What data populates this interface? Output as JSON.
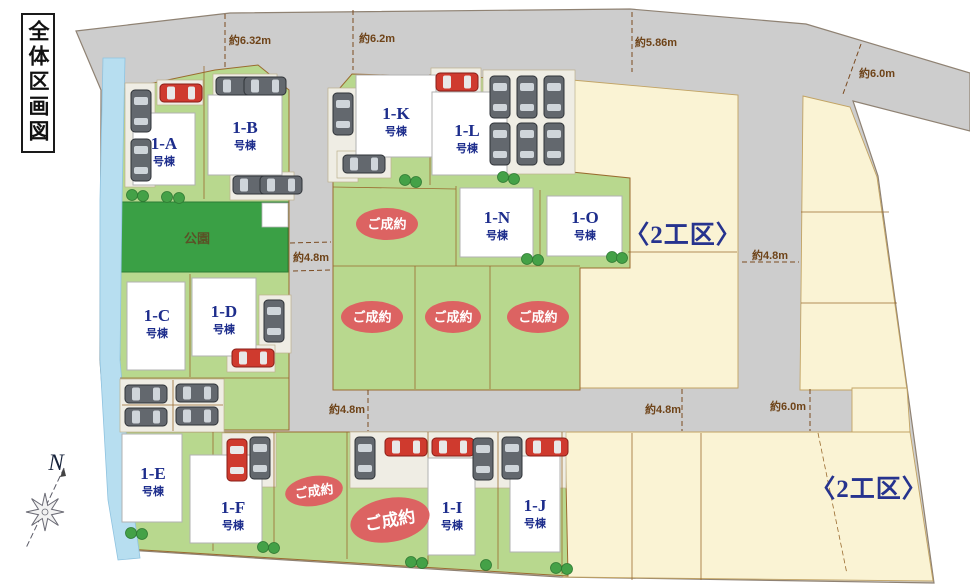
{
  "title": "全体区画図",
  "park": {
    "label": "公園"
  },
  "compass": {
    "label": "N"
  },
  "unit_suffix": "号棟",
  "sold_label": "ご成約",
  "zones": [
    {
      "label": "〈2工区〉",
      "x": 683,
      "y": 243
    },
    {
      "label": "〈2工区〉",
      "x": 869,
      "y": 497
    }
  ],
  "houses": [
    {
      "id": "1-A",
      "x": 133,
      "y": 113,
      "w": 62,
      "h": 72,
      "lx": 164,
      "ly": 149
    },
    {
      "id": "1-B",
      "x": 208,
      "y": 95,
      "w": 74,
      "h": 80,
      "lx": 245,
      "ly": 133
    },
    {
      "id": "1-C",
      "x": 127,
      "y": 282,
      "w": 58,
      "h": 88,
      "lx": 157,
      "ly": 321
    },
    {
      "id": "1-D",
      "x": 192,
      "y": 278,
      "w": 64,
      "h": 78,
      "lx": 224,
      "ly": 317
    },
    {
      "id": "1-E",
      "x": 122,
      "y": 434,
      "w": 60,
      "h": 88,
      "lx": 153,
      "ly": 479
    },
    {
      "id": "1-F",
      "x": 190,
      "y": 455,
      "w": 72,
      "h": 88,
      "lx": 233,
      "ly": 513
    },
    {
      "id": "1-I",
      "x": 428,
      "y": 458,
      "w": 47,
      "h": 97,
      "lx": 452,
      "ly": 513
    },
    {
      "id": "1-J",
      "x": 510,
      "y": 456,
      "w": 50,
      "h": 96,
      "lx": 535,
      "ly": 511
    },
    {
      "id": "1-K",
      "x": 356,
      "y": 75,
      "w": 80,
      "h": 82,
      "lx": 396,
      "ly": 119
    },
    {
      "id": "1-L",
      "x": 432,
      "y": 92,
      "w": 75,
      "h": 83,
      "lx": 467,
      "ly": 136
    },
    {
      "id": "1-N",
      "x": 460,
      "y": 188,
      "w": 73,
      "h": 69,
      "lx": 497,
      "ly": 223
    },
    {
      "id": "1-O",
      "x": 547,
      "y": 196,
      "w": 75,
      "h": 60,
      "lx": 585,
      "ly": 223
    }
  ],
  "sold": [
    {
      "cx": 387,
      "cy": 224,
      "rx": 31,
      "ry": 16,
      "rot": 0,
      "fs": 13
    },
    {
      "cx": 372,
      "cy": 317,
      "rx": 31,
      "ry": 16,
      "rot": 0,
      "fs": 13
    },
    {
      "cx": 453,
      "cy": 317,
      "rx": 28,
      "ry": 16,
      "rot": 0,
      "fs": 13
    },
    {
      "cx": 538,
      "cy": 317,
      "rx": 31,
      "ry": 16,
      "rot": 0,
      "fs": 13
    },
    {
      "cx": 314,
      "cy": 491,
      "rx": 29,
      "ry": 15,
      "rot": -8,
      "fs": 13
    },
    {
      "cx": 390,
      "cy": 520,
      "rx": 40,
      "ry": 22,
      "rot": -10,
      "fs": 17
    }
  ],
  "measurements": [
    {
      "text": "約6.32m",
      "x": 250,
      "y": 44
    },
    {
      "text": "約6.2m",
      "x": 377,
      "y": 42
    },
    {
      "text": "約5.86m",
      "x": 656,
      "y": 46
    },
    {
      "text": "約6.0m",
      "x": 877,
      "y": 77
    },
    {
      "text": "約4.8m",
      "x": 311,
      "y": 261
    },
    {
      "text": "約4.8m",
      "x": 770,
      "y": 259
    },
    {
      "text": "約4.8m",
      "x": 347,
      "y": 413
    },
    {
      "text": "約4.8m",
      "x": 663,
      "y": 413
    },
    {
      "text": "約6.0m",
      "x": 788,
      "y": 410
    }
  ],
  "cars": [
    {
      "x": 131,
      "y": 90,
      "o": "v",
      "c": "g"
    },
    {
      "x": 131,
      "y": 139,
      "o": "v",
      "c": "g"
    },
    {
      "x": 160,
      "y": 84,
      "o": "h",
      "c": "r"
    },
    {
      "x": 216,
      "y": 77,
      "o": "h",
      "c": "g"
    },
    {
      "x": 244,
      "y": 77,
      "o": "h",
      "c": "g"
    },
    {
      "x": 233,
      "y": 176,
      "o": "h",
      "c": "g"
    },
    {
      "x": 260,
      "y": 176,
      "o": "h",
      "c": "g"
    },
    {
      "x": 264,
      "y": 300,
      "o": "v",
      "c": "g"
    },
    {
      "x": 232,
      "y": 349,
      "o": "h",
      "c": "r"
    },
    {
      "x": 125,
      "y": 385,
      "o": "h",
      "c": "g"
    },
    {
      "x": 176,
      "y": 384,
      "o": "h",
      "c": "g"
    },
    {
      "x": 125,
      "y": 408,
      "o": "h",
      "c": "g"
    },
    {
      "x": 176,
      "y": 407,
      "o": "h",
      "c": "g"
    },
    {
      "x": 333,
      "y": 93,
      "o": "v",
      "c": "g"
    },
    {
      "x": 343,
      "y": 155,
      "o": "h",
      "c": "g"
    },
    {
      "x": 436,
      "y": 73,
      "o": "h",
      "c": "r"
    },
    {
      "x": 490,
      "y": 76,
      "o": "v",
      "c": "g"
    },
    {
      "x": 517,
      "y": 76,
      "o": "v",
      "c": "g"
    },
    {
      "x": 544,
      "y": 76,
      "o": "v",
      "c": "g"
    },
    {
      "x": 490,
      "y": 123,
      "o": "v",
      "c": "g"
    },
    {
      "x": 517,
      "y": 123,
      "o": "v",
      "c": "g"
    },
    {
      "x": 544,
      "y": 123,
      "o": "v",
      "c": "g"
    },
    {
      "x": 227,
      "y": 439,
      "o": "v",
      "c": "r"
    },
    {
      "x": 250,
      "y": 437,
      "o": "v",
      "c": "g"
    },
    {
      "x": 355,
      "y": 437,
      "o": "v",
      "c": "g"
    },
    {
      "x": 385,
      "y": 438,
      "o": "h",
      "c": "r"
    },
    {
      "x": 432,
      "y": 438,
      "o": "h",
      "c": "r"
    },
    {
      "x": 473,
      "y": 438,
      "o": "v",
      "c": "g"
    },
    {
      "x": 502,
      "y": 437,
      "o": "v",
      "c": "g"
    },
    {
      "x": 526,
      "y": 438,
      "o": "h",
      "c": "r"
    }
  ],
  "trees": [
    {
      "x": 167,
      "y": 197
    },
    {
      "x": 179,
      "y": 198
    },
    {
      "x": 132,
      "y": 195
    },
    {
      "x": 143,
      "y": 196
    },
    {
      "x": 405,
      "y": 180
    },
    {
      "x": 416,
      "y": 182
    },
    {
      "x": 503,
      "y": 177
    },
    {
      "x": 514,
      "y": 179
    },
    {
      "x": 527,
      "y": 259
    },
    {
      "x": 538,
      "y": 260
    },
    {
      "x": 612,
      "y": 257
    },
    {
      "x": 622,
      "y": 258
    },
    {
      "x": 131,
      "y": 533
    },
    {
      "x": 142,
      "y": 534
    },
    {
      "x": 263,
      "y": 547
    },
    {
      "x": 274,
      "y": 548
    },
    {
      "x": 411,
      "y": 562
    },
    {
      "x": 422,
      "y": 563
    },
    {
      "x": 486,
      "y": 565
    },
    {
      "x": 556,
      "y": 568
    },
    {
      "x": 567,
      "y": 569
    }
  ],
  "colors": {
    "road": "#cdcdcd",
    "lot_green": "#b8d88e",
    "park_green": "#3aa045",
    "cream": "#faf3d4",
    "stream_blue": "#b7def0",
    "sold_red": "#dc6362",
    "house_white": "#ffffff",
    "navy": "#1d2d8c",
    "dim_brown": "#6e4318",
    "pavement": "#efede4"
  }
}
